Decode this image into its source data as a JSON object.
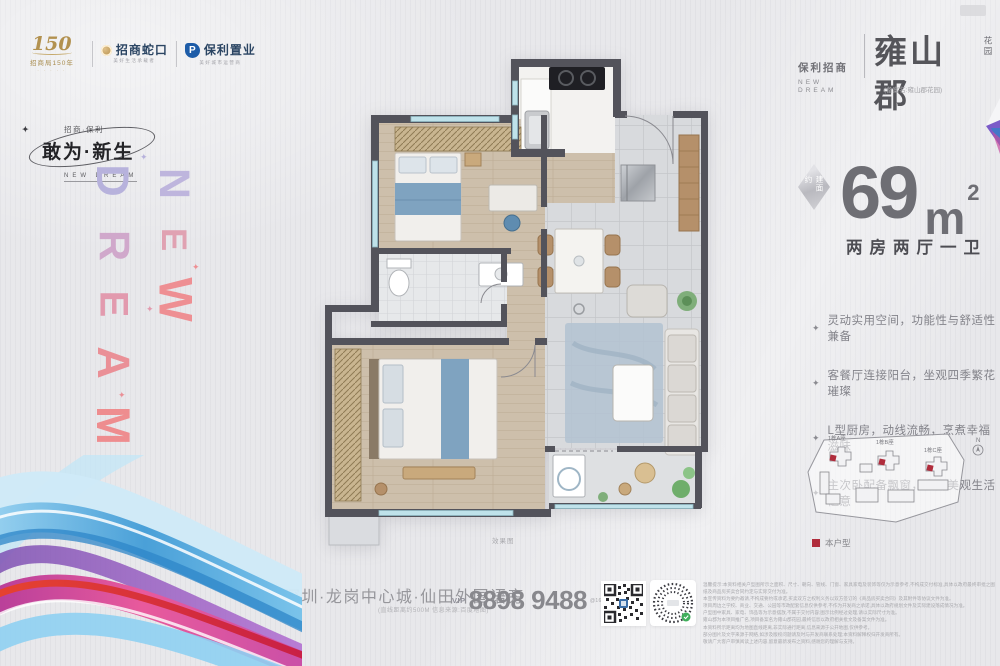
{
  "colors": {
    "accent_red": "#b02c3c",
    "wall": "#53535b",
    "gold": "#b2914f",
    "navy": "#2b4563",
    "gradient_top": "#b7b2dc",
    "gradient_bottom": "#ee8d8f"
  },
  "brand_bar": {
    "cm150": {
      "number": "150",
      "label": "招商局150年"
    },
    "cmsk": {
      "name": "招商蛇口",
      "tagline": "美好生活承载者"
    },
    "poly": {
      "initial": "P",
      "name": "保利置业",
      "tagline": "美好城市运营商"
    }
  },
  "campaign": {
    "small": "招商·保利",
    "title": "敢为·新生",
    "en": "NEW DREAM"
  },
  "vertical": {
    "dream": "DREAM",
    "new": "NEW",
    "sparkle": "✦"
  },
  "project": {
    "brand": "保利招商",
    "brand_en": "NEW DREAM",
    "name": "雍山郡",
    "suffix": "花园",
    "record": "(备案名:雍山郡花园)"
  },
  "area": {
    "badge": "建面约",
    "value": "69",
    "unit": "m",
    "sup": "2",
    "layout": "两房两厅一卫"
  },
  "features": [
    "灵动实用空间，功能性与舒适性兼备",
    "客餐厅连接阳台，坐观四季繁花璀璨",
    "L型厨房，动线流畅，烹煮幸福滋味",
    "主次卧配备飘窗，实用美观生活惬意"
  ],
  "siteplan": {
    "b1": "1栋A座",
    "b2": "1栋B座",
    "b3": "1栋C座",
    "north": "N",
    "legend": "本户型"
  },
  "floorplan": {
    "caption": "效果图"
  },
  "footer": {
    "address": "深圳·龙岗中心城·仙田外国语旁",
    "address_note": "(直线距离约500M 信息来源:百度地图)",
    "vip": "VIP",
    "phone": "8898 9488",
    "phone_suffix": "@163.COM",
    "disclaimer": [
      "温馨提示:本资料相关户型图所示之面积、尺寸、朝向、管线、门窗、家具家电及装饰等仅为示意参考,不构成交付标准,具体以政府最终审批之图纸及商品房买卖合同约定与实际交付为准。",
      "本宣传资料为要约邀请,不构成要约或承诺,买卖双方之权利义务以双方签订的《商品房买卖合同》及其附件等协议文件为准。",
      "项目周边之学校、商业、交通、公园等市政配套信息仅供参考,不作为开发商之承诺,具体以政府规划文件及实际建设落成情况为准。",
      "户型图中家具、家电、饰品等为示意摆放,不属于交付内容;图示比例经过处理,请以实际尺寸为准。",
      "雍山郡为本项目推广名,项目备案名为雍山郡花园,最终信息以政府相关批文及备案文件为准。",
      "本资料所示距离均为地图直线距离,非实际通行距离,信息来源于公开地图,仅供参考。",
      "部分图片及文字来源于网络,如涉及版权问题请及时与开发商联系处理;本资料解释权归开发商所有。",
      "敬请广大客户审慎阅读上述内容,留意最新发布之资料,感谢您的理解与支持。"
    ]
  }
}
